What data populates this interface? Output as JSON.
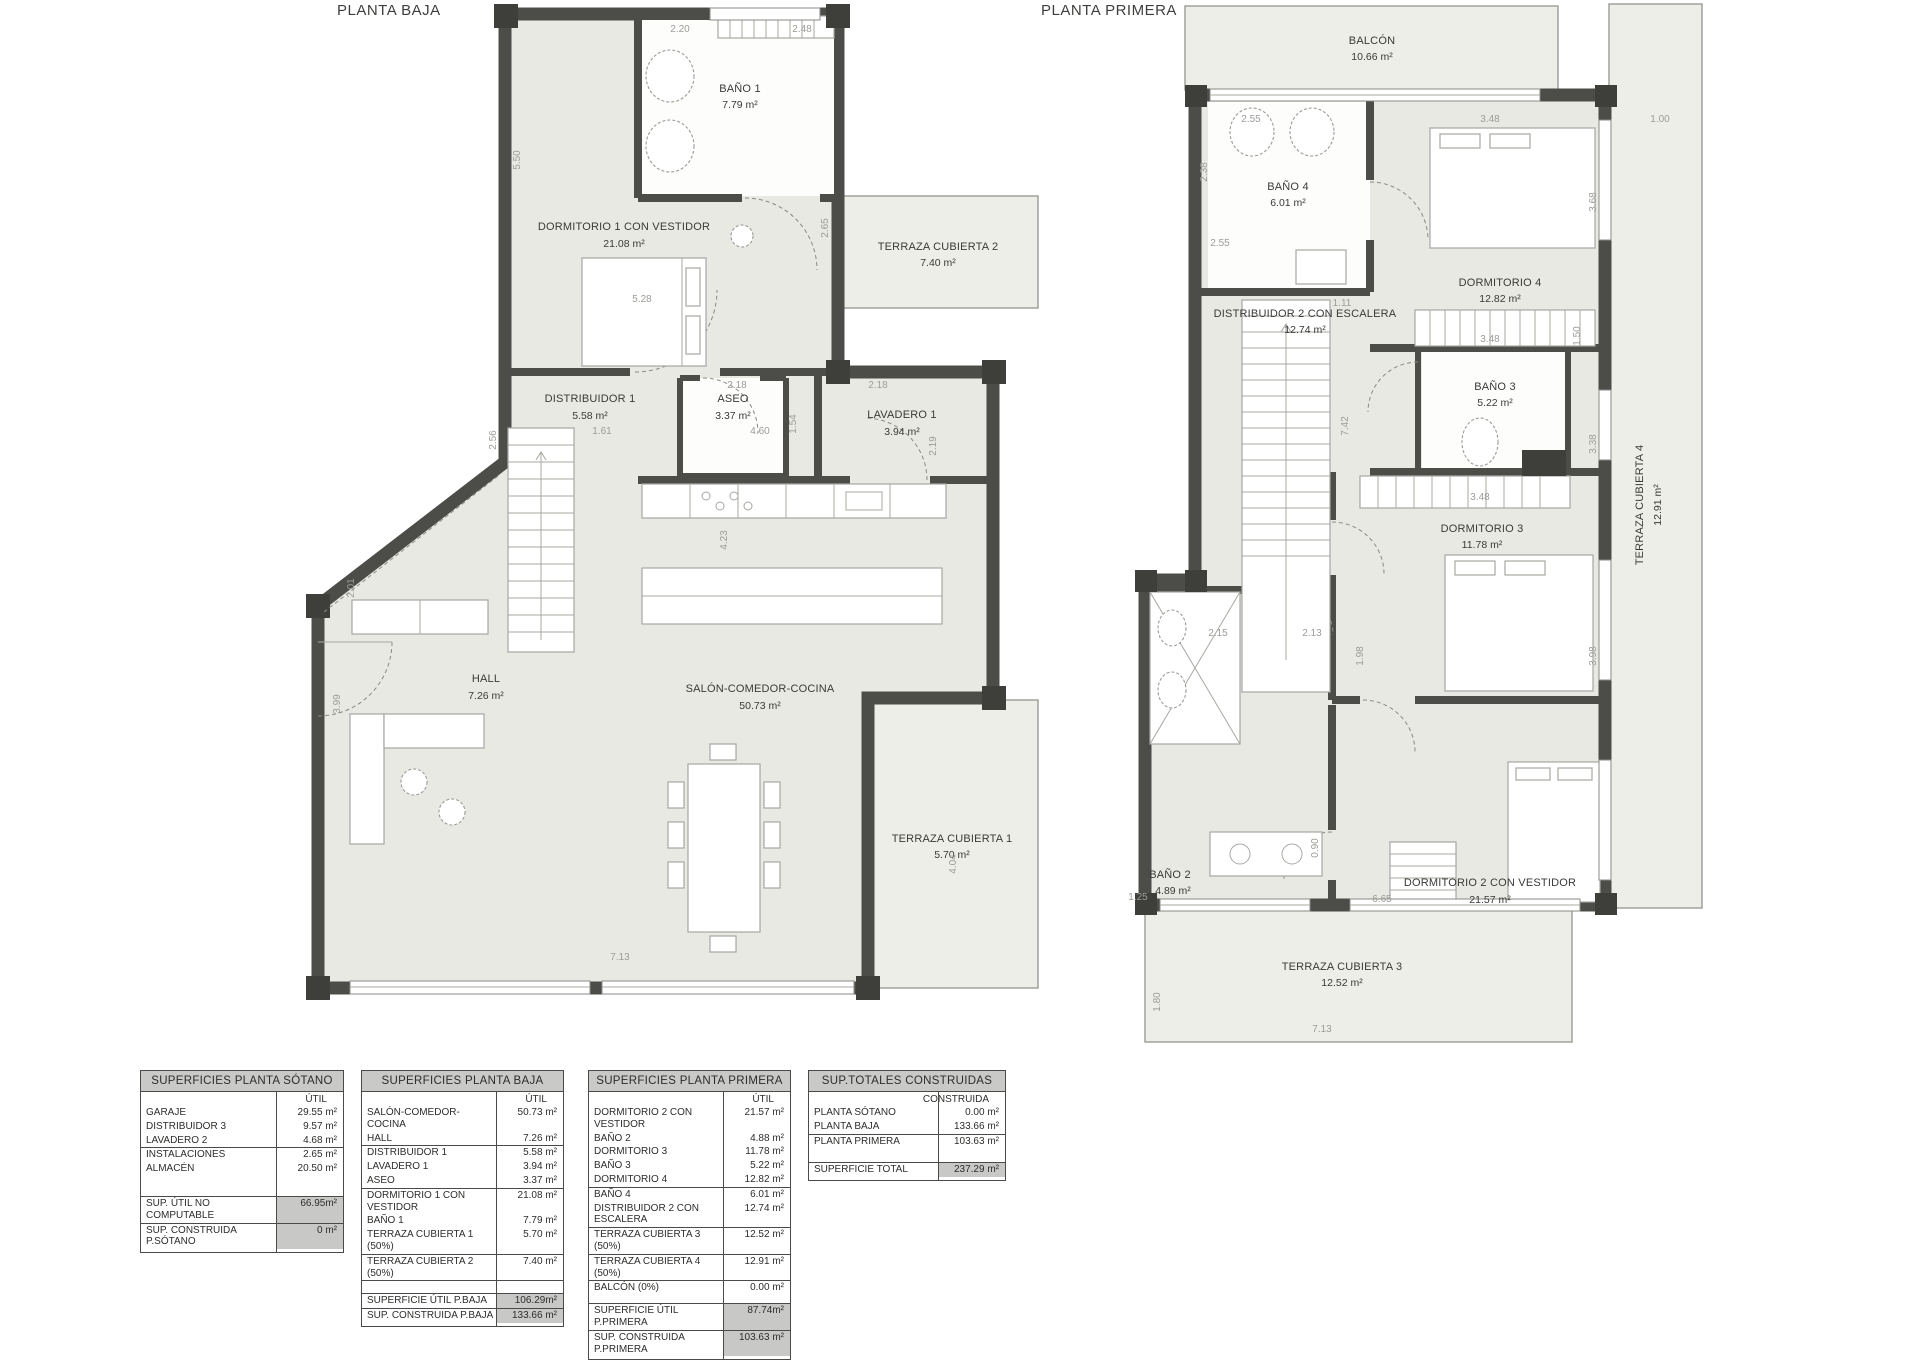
{
  "plans": {
    "planta_baja": {
      "title": "PLANTA BAJA",
      "rooms": {
        "bano_1": {
          "name": "BAÑO 1",
          "area": "7.79 m²"
        },
        "dormitorio_1": {
          "name": "DORMITORIO 1 CON VESTIDOR",
          "area": "21.08 m²"
        },
        "terraza_2": {
          "name": "TERRAZA CUBIERTA 2",
          "area": "7.40 m²"
        },
        "distribuidor_1": {
          "name": "DISTRIBUIDOR 1",
          "area": "5.58 m²"
        },
        "aseo": {
          "name": "ASEO",
          "area": "3.37 m²"
        },
        "lavadero_1": {
          "name": "LAVADERO 1",
          "area": "3.94 m²"
        },
        "hall": {
          "name": "HALL",
          "area": "7.26 m²"
        },
        "salon": {
          "name": "SALÓN-COMEDOR-COCINA",
          "area": "50.73 m²"
        },
        "terraza_1": {
          "name": "TERRAZA CUBIERTA 1",
          "area": "5.70 m²"
        }
      },
      "dims": [
        "2.20",
        "2.48",
        "5.50",
        "2.65",
        "5.28",
        "2.18",
        "1.54",
        "2.18",
        "2.19",
        "1.61",
        "4.60",
        "2.56",
        "4.23",
        "2.01",
        "3.99",
        "4.04",
        "7.13"
      ]
    },
    "planta_primera": {
      "title": "PLANTA PRIMERA",
      "rooms": {
        "balcon": {
          "name": "BALCÓN",
          "area": "10.66 m²"
        },
        "bano_4": {
          "name": "BAÑO 4",
          "area": "6.01 m²"
        },
        "dormitorio_4": {
          "name": "DORMITORIO 4",
          "area": "12.82 m²"
        },
        "distribuidor_2": {
          "name": "DISTRIBUIDOR 2 CON ESCALERA",
          "area": "12.74 m²"
        },
        "bano_3": {
          "name": "BAÑO 3",
          "area": "5.22 m²"
        },
        "dormitorio_3": {
          "name": "DORMITORIO 3",
          "area": "11.78 m²"
        },
        "terraza_4": {
          "name": "TERRAZA CUBIERTA 4",
          "area": "12.91 m²"
        },
        "bano_2": {
          "name": "BAÑO 2",
          "area": "4.89 m²"
        },
        "dormitorio_2": {
          "name": "DORMITORIO 2 CON VESTIDOR",
          "area": "21.57 m²"
        },
        "terraza_3": {
          "name": "TERRAZA CUBIERTA 3",
          "area": "12.52 m²"
        }
      },
      "dims": [
        "2.55",
        "3.48",
        "1.00",
        "2.38",
        "3.68",
        "2.55",
        "1.11",
        "3.48",
        "1.50",
        "7.42",
        "3.38",
        "3.48",
        "2.15",
        "2.13",
        "1.98",
        "3.98",
        "0.90",
        "6.65",
        "1.25",
        "1.80",
        "7.13"
      ]
    }
  },
  "tables": [
    {
      "title": "SUPERFICIES PLANTA SÓTANO",
      "col": "ÚTIL",
      "rows": [
        {
          "label": "GARAJE",
          "value": "29.55 m²"
        },
        {
          "label": "DISTRIBUIDOR 3",
          "value": "9.57 m²"
        },
        {
          "label": "LAVADERO 2",
          "value": "4.68 m²"
        },
        {
          "label": "INSTALACIONES",
          "value": "2.65 m²"
        },
        {
          "label": "ALMACÉN",
          "value": "20.50 m²"
        }
      ],
      "summary": [
        {
          "label": "SUP. ÚTIL NO COMPUTABLE",
          "value": "66.95m²"
        },
        {
          "label": "SUP. CONSTRUIDA P.SÓTANO",
          "value": "0 m²"
        }
      ]
    },
    {
      "title": "SUPERFICIES PLANTA BAJA",
      "col": "ÚTIL",
      "rows": [
        {
          "label": "SALÓN-COMEDOR-COCINA",
          "value": "50.73 m²"
        },
        {
          "label": "HALL",
          "value": "7.26 m²"
        },
        {
          "label": "DISTRIBUIDOR 1",
          "value": "5.58 m²"
        },
        {
          "label": "LAVADERO 1",
          "value": "3.94 m²"
        },
        {
          "label": "ASEO",
          "value": "3.37 m²"
        },
        {
          "label": "DORMITORIO 1 CON VESTIDOR",
          "value": "21.08 m²"
        },
        {
          "label": "BAÑO 1",
          "value": "7.79 m²"
        },
        {
          "label": "TERRAZA CUBIERTA 1 (50%)",
          "value": "5.70 m²"
        },
        {
          "label": "TERRAZA CUBIERTA 2 (50%)",
          "value": "7.40 m²"
        }
      ],
      "summary": [
        {
          "label": "SUPERFICIE ÚTIL P.BAJA",
          "value": "106.29m²"
        },
        {
          "label": "SUP. CONSTRUIDA P.BAJA",
          "value": "133.66 m²"
        }
      ]
    },
    {
      "title": "SUPERFICIES PLANTA PRIMERA",
      "col": "ÚTIL",
      "rows": [
        {
          "label": "DORMITORIO 2 CON VESTIDOR",
          "value": "21.57 m²"
        },
        {
          "label": "BAÑO 2",
          "value": "4.88 m²"
        },
        {
          "label": "DORMITORIO 3",
          "value": "11.78 m²"
        },
        {
          "label": "BAÑO 3",
          "value": "5.22 m²"
        },
        {
          "label": "DORMITORIO 4",
          "value": "12.82 m²"
        },
        {
          "label": "BAÑO 4",
          "value": "6.01 m²"
        },
        {
          "label": "DISTRIBUIDOR 2 CON ESCALERA",
          "value": "12.74 m²"
        },
        {
          "label": "TERRAZA CUBIERTA 3 (50%)",
          "value": "12.52 m²"
        },
        {
          "label": "TERRAZA CUBIERTA 4 (50%)",
          "value": "12.91 m²"
        },
        {
          "label": "BALCÓN (0%)",
          "value": "0.00 m²"
        }
      ],
      "summary": [
        {
          "label": "SUPERFICIE ÚTIL P.PRIMERA",
          "value": "87.74m²"
        },
        {
          "label": "SUP. CONSTRUIDA P.PRIMERA",
          "value": "103.63 m²"
        }
      ]
    },
    {
      "title": "SUP.TOTALES CONSTRUIDAS",
      "col": "CONSTRUIDA",
      "rows": [
        {
          "label": "PLANTA SÓTANO",
          "value": "0.00 m²"
        },
        {
          "label": "PLANTA BAJA",
          "value": "133.66 m²"
        },
        {
          "label": "PLANTA PRIMERA",
          "value": "103.63 m²"
        }
      ],
      "summary": [
        {
          "label": "SUPERFICIE TOTAL",
          "value": "237.29 m²"
        }
      ]
    }
  ]
}
